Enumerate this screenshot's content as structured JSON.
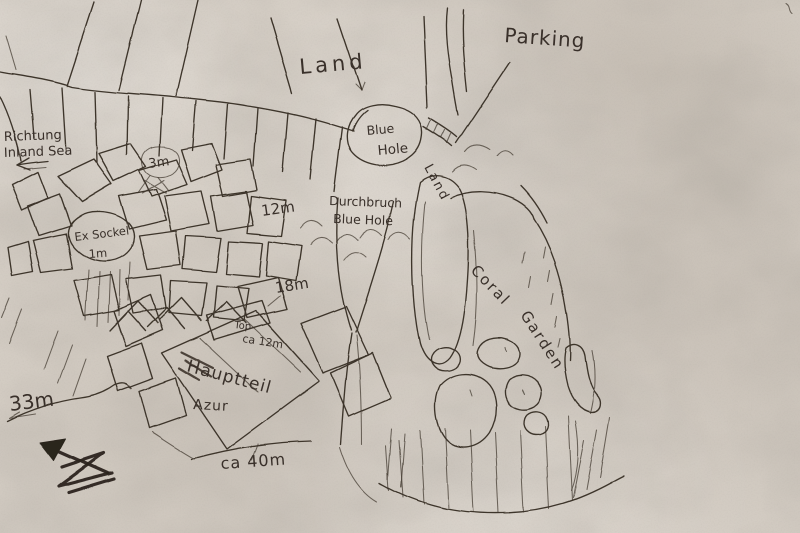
{
  "map": {
    "colors": {
      "ink": "#3d342b",
      "ink_heavy": "#2c251f",
      "paper": "#d5cec5"
    },
    "labels": {
      "parking": "Parking",
      "land_top": "Land",
      "richtung_line1": "Richtung",
      "richtung_line2": "Inland Sea",
      "depth_3m": "3m",
      "ex_sockel_line1": "Ex Sockel",
      "ex_sockel_line2": "1m",
      "depth_12m": "12m",
      "blue_hole_line1": "Blue",
      "blue_hole_line2": "Hole",
      "land_side": "Land",
      "durchbruch_line1": "Durchbruch",
      "durchbruch_line2": "Blue Hole",
      "coral_line1": "Coral",
      "coral_line2": "Garden",
      "depth_18m": "18m",
      "top_block_line1": "Top",
      "top_block_line2": "ca 12m",
      "hauptteil_line1": "Hauptteil",
      "hauptteil_line2": "Azur",
      "depth_33m": "33m",
      "depth_ca_40m": "ca 40m"
    },
    "icons": {
      "north_arrow": "north-arrow",
      "inland_sea_arrow": "left-arrow"
    }
  }
}
